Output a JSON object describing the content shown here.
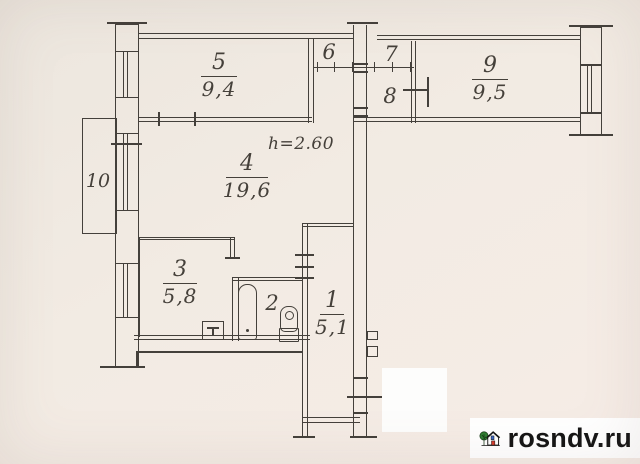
{
  "plan": {
    "ceiling_height_label": "h=2.60",
    "rooms": {
      "r1": {
        "number": "1",
        "area": "5,1"
      },
      "r2": {
        "number": "2"
      },
      "r3": {
        "number": "3",
        "area": "5,8"
      },
      "r4": {
        "number": "4",
        "area": "19,6"
      },
      "r5": {
        "number": "5",
        "area": "9,4"
      },
      "r6": {
        "number": "6"
      },
      "r7": {
        "number": "7"
      },
      "r8": {
        "number": "8"
      },
      "r9": {
        "number": "9",
        "area": "9,5"
      },
      "r10": {
        "number": "10"
      }
    },
    "icons": {
      "bathtub": "bathtub-outline",
      "toilet": "toilet-outline",
      "stove": "stove-square-with-T",
      "window": "double-line-window"
    }
  },
  "watermark": {
    "text": "rosndv.ru",
    "logo": "house-with-tree",
    "colors": {
      "tree_green": "#2e7d32",
      "door_red": "#d63c2e",
      "window_blue": "#3b67c6",
      "text": "#141414",
      "background": "#ffffff"
    }
  },
  "colors": {
    "paper": "#f0e9e1",
    "line": "#44403b",
    "ink": "#45403a"
  }
}
